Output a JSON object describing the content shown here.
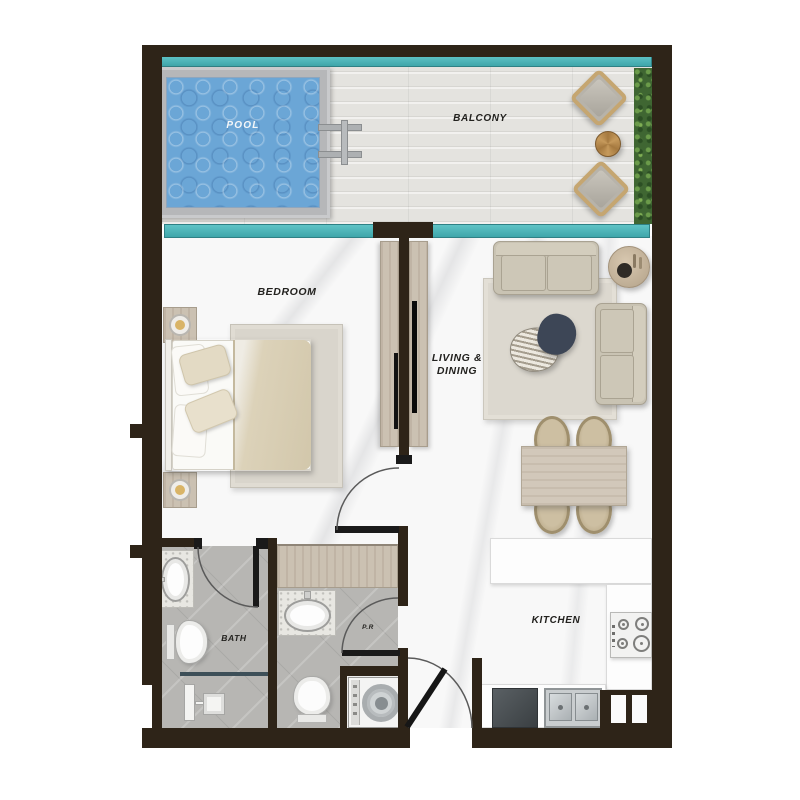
{
  "title": "Apartment floor plan",
  "labels": {
    "pool": "POOL",
    "balcony": "BALCONY",
    "bedroom": "BEDROOM",
    "living_line1": "LIVING &",
    "living_line2": "DINING",
    "bath": "BATH",
    "powder_room": "P.R",
    "kitchen": "KITCHEN"
  },
  "colors": {
    "wall": "#2e2418",
    "glass": "#4fb4b8",
    "pool-water": "#6ba6d6",
    "pool-frame": "#b6b7b9",
    "balcony-floor": "#e4e3df",
    "marble": "#f8f8f8",
    "tile": "#b7b6b3",
    "wood": "#cbc1b2",
    "hedge": "#3f6632",
    "sofa-beige": "#c9c3b3",
    "coffee-table-dark": "#3d4656",
    "lamp-gold": "#d9b467",
    "label-ink": "#23221f",
    "pool-label-ink": "#f4f7f9"
  }
}
